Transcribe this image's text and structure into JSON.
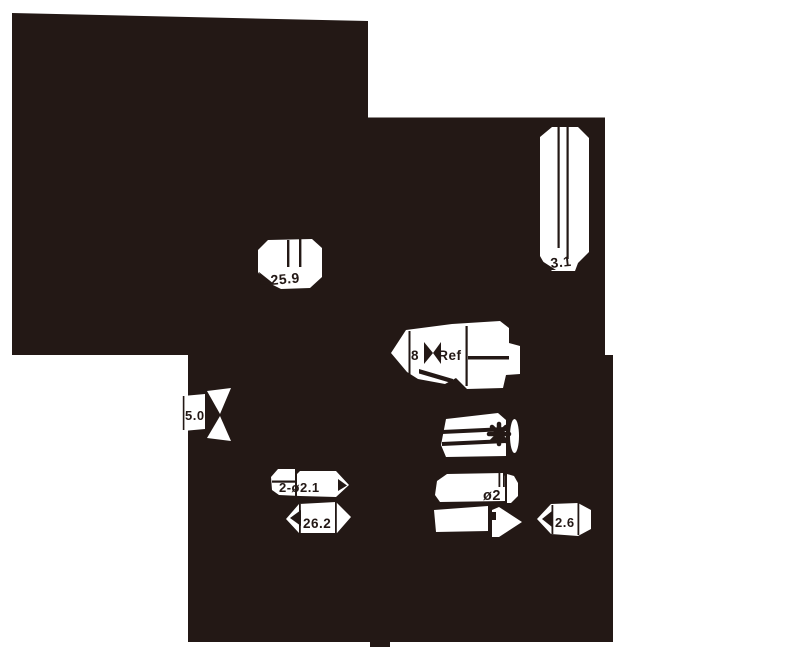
{
  "colors": {
    "ink": "#231815",
    "paper": "#ffffff"
  },
  "drawing": {
    "dimensions": {
      "d25_9": "25.9",
      "d3_1": "3.1",
      "d8_ref": "8 Ref",
      "d5_0": "5.0",
      "d2x_dia2_1": "2-ø2.1",
      "d26_2": "26.2",
      "dia2": "ø2",
      "d2_6": "2.6"
    },
    "symbols": {
      "asterisk_marker": "✱"
    }
  }
}
